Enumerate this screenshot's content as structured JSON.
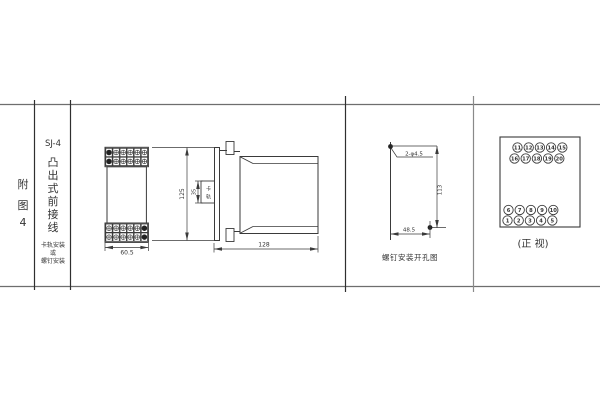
{
  "left_panel": {
    "figure_chars": [
      "附",
      "图",
      "4"
    ]
  },
  "type_panel": {
    "model": "SJ-4",
    "description_chars": [
      "凸",
      "出",
      "式",
      "前",
      "接",
      "线"
    ],
    "mounting_lines": [
      "卡轨安装",
      "或",
      "螺钉安装"
    ]
  },
  "front_view": {
    "width_dim": "60.5",
    "height_dim": "125"
  },
  "side_view": {
    "depth_dim": "128",
    "rail_height_dim": "35",
    "rail_label_chars": [
      "卡",
      "轨"
    ]
  },
  "drill_view": {
    "holes_label": "2-φ4.5",
    "height_dim": "113",
    "width_dim": "48.5",
    "caption": "螺钉安装开孔图"
  },
  "terminal_view": {
    "caption": "(正 视)",
    "rows": [
      [
        "11",
        "12",
        "13",
        "14",
        "15"
      ],
      [
        "16",
        "17",
        "18",
        "19",
        "20"
      ],
      [
        "6",
        "7",
        "8",
        "9",
        "10"
      ],
      [
        "1",
        "2",
        "3",
        "4",
        "5"
      ]
    ]
  },
  "colors": {
    "line": "#3a3a3a",
    "text": "#333333",
    "divider": "#4a4a4a",
    "background": "#ffffff"
  }
}
